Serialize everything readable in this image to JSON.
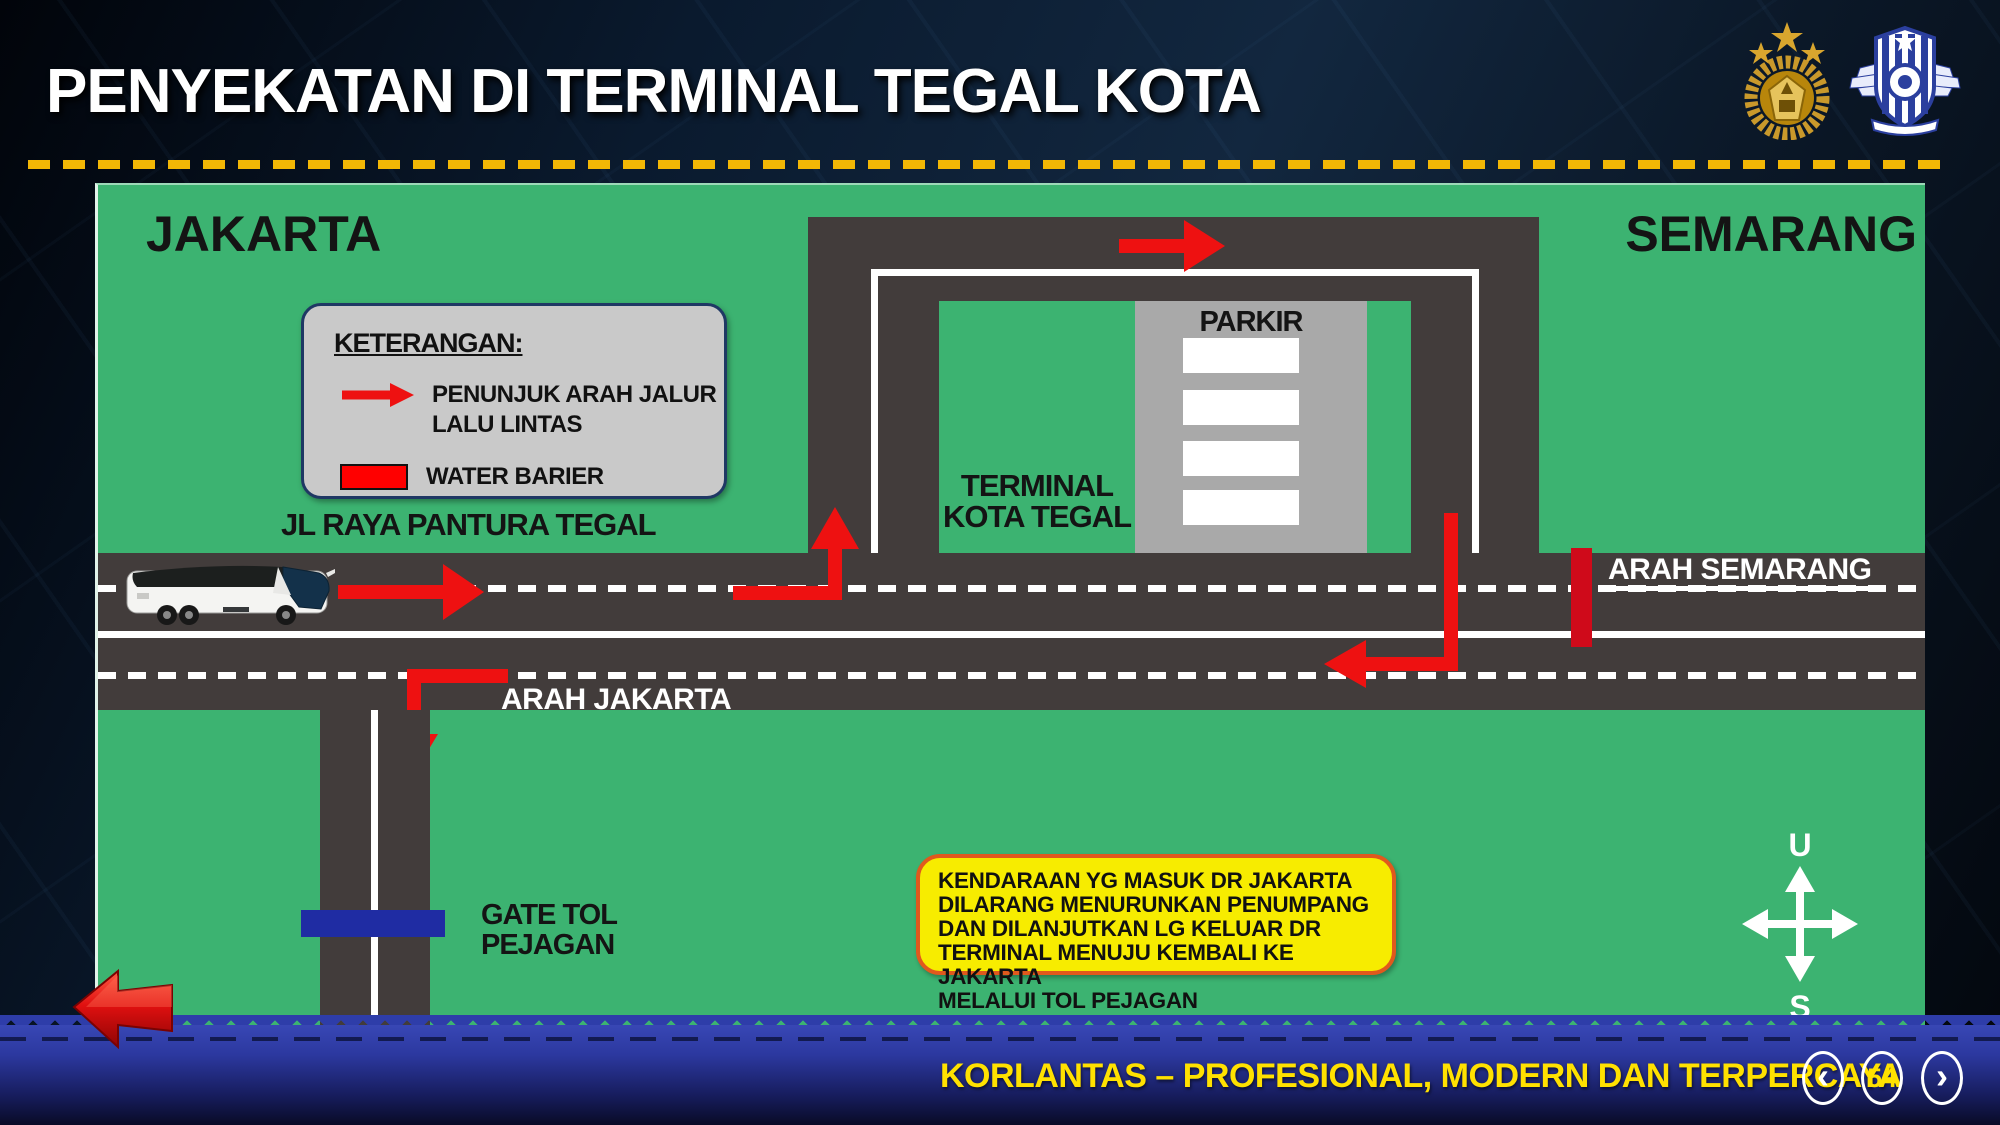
{
  "slide": {
    "title": "PENYEKATAN DI TERMINAL TEGAL KOTA",
    "footer": {
      "tagline": "KORLANTAS – PROFESIONAL, MODERN DAN TERPERCAYA",
      "page_number": "54",
      "prev_label": "‹",
      "next_label": "›"
    }
  },
  "legend": {
    "heading": "KETERANGAN:",
    "arrow_label": "PENUNJUK ARAH JALUR\nLALU LINTAS",
    "barrier_label": "WATER BARIER"
  },
  "map": {
    "city_left": "JAKARTA",
    "city_right": "SEMARANG",
    "road_name": "JL RAYA PANTURA TEGAL",
    "direction_right": "ARAH SEMARANG",
    "direction_left": "ARAH JAKARTA",
    "parking_label": "PARKIR",
    "terminal_label": "TERMINAL\nKOTA TEGAL",
    "toll_gate_label": "GATE TOL\nPEJAGAN",
    "note": "KENDARAAN YG MASUK DR JAKARTA\nDILARANG MENURUNKAN PENUMPANG\nDAN DILANJUTKAN LG KELUAR DR\nTERMINAL MENUJU KEMBALI KE JAKARTA\nMELALUI TOL PEJAGAN",
    "compass": {
      "north": "U",
      "south": "S"
    }
  },
  "colors": {
    "map_green": "#3cb371",
    "road_gray": "#423c3b",
    "parking_gray": "#a9a9a9",
    "legend_gray": "#c9c9c9",
    "legend_border": "#1f3864",
    "note_yellow": "#f7ec00",
    "note_border": "#e0591d",
    "gate_blue": "#1f2ca3",
    "barrier_red": "#cf0a1a",
    "arrow_red": "#ee1111",
    "rule_yellow": "#f2b705",
    "footer_yellow": "#ffe100",
    "bar_blue": "#2c389f"
  }
}
